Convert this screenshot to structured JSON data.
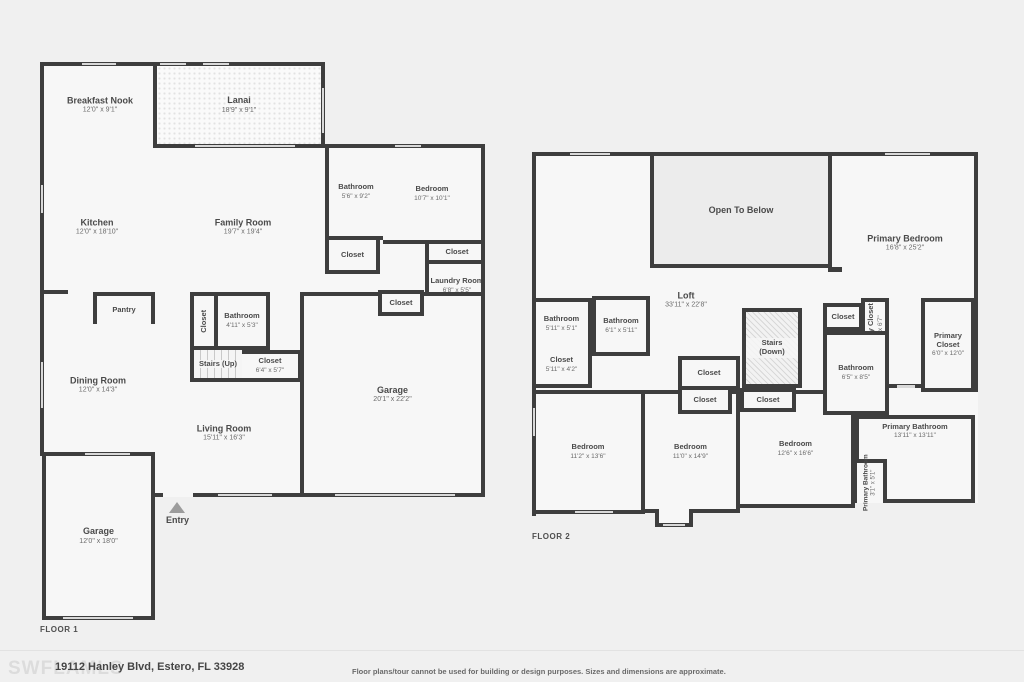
{
  "floor1": {
    "label": "FLOOR 1",
    "rooms": {
      "breakfast_nook": {
        "name": "Breakfast Nook",
        "dims": "12'0\" x 9'1\""
      },
      "lanai": {
        "name": "Lanai",
        "dims": "18'9\" x 9'1\""
      },
      "kitchen": {
        "name": "Kitchen",
        "dims": "12'0\" x 18'10\""
      },
      "family_room": {
        "name": "Family Room",
        "dims": "19'7\" x 19'4\""
      },
      "bathroom1": {
        "name": "Bathroom",
        "dims": "5'6\" x 9'2\""
      },
      "bedroom": {
        "name": "Bedroom",
        "dims": "10'7\" x 10'1\""
      },
      "closet_bath": {
        "name": "Closet"
      },
      "closet_bedroom": {
        "name": "Closet"
      },
      "laundry": {
        "name": "Laundry Room",
        "dims": "6'8\" x 5'5\""
      },
      "closet_garage": {
        "name": "Closet"
      },
      "pantry": {
        "name": "Pantry"
      },
      "closet_stairs": {
        "name": "Closet"
      },
      "bathroom2": {
        "name": "Bathroom",
        "dims": "4'11\" x 5'3\""
      },
      "stairs_up": {
        "name": "Stairs (Up)"
      },
      "closet_hall": {
        "name": "Closet",
        "dims": "6'4\" x 5'7\""
      },
      "dining_room": {
        "name": "Dining Room",
        "dims": "12'0\" x 14'3\""
      },
      "living_room": {
        "name": "Living Room",
        "dims": "15'11\" x 16'3\""
      },
      "garage_main": {
        "name": "Garage",
        "dims": "20'1\" x 22'2\""
      },
      "garage_left": {
        "name": "Garage",
        "dims": "12'0\" x 18'0\""
      },
      "entry": {
        "name": "Entry"
      }
    }
  },
  "floor2": {
    "label": "FLOOR 2",
    "rooms": {
      "open_to_below": {
        "name": "Open To Below"
      },
      "primary_bedroom": {
        "name": "Primary Bedroom",
        "dims": "16'8\" x 25'2\""
      },
      "loft": {
        "name": "Loft",
        "dims": "33'11\" x 22'8\""
      },
      "bathroom_a": {
        "name": "Bathroom",
        "dims": "5'11\" x 5'1\""
      },
      "bathroom_b": {
        "name": "Bathroom",
        "dims": "6'1\" x 5'11\""
      },
      "closet_a": {
        "name": "Closet",
        "dims": "5'11\" x 4'2\""
      },
      "closet_stair": {
        "name": "Closet"
      },
      "closet_bl": {
        "name": "Closet"
      },
      "closet_br": {
        "name": "Closet"
      },
      "stairs_down": {
        "name": "Stairs (Down)"
      },
      "closet_c": {
        "name": "Closet"
      },
      "primary_closet_small": {
        "name": "Primary Closet",
        "dims": "3'1\" x 6'7\""
      },
      "bathroom_c": {
        "name": "Bathroom",
        "dims": "6'5\" x 8'5\""
      },
      "primary_closet": {
        "name": "Primary Closet",
        "dims": "6'0\" x 12'0\""
      },
      "bedroom_l": {
        "name": "Bedroom",
        "dims": "11'2\" x 13'6\""
      },
      "bedroom_m": {
        "name": "Bedroom",
        "dims": "11'0\" x 14'9\""
      },
      "bedroom_r": {
        "name": "Bedroom",
        "dims": "12'6\" x 16'6\""
      },
      "primary_bathroom": {
        "name": "Primary Bathroom",
        "dims": "13'11\" x 13'11\""
      },
      "primary_bathroom_small": {
        "name": "Primary Bathroom",
        "dims": "3'1\" x 5'1\""
      }
    }
  },
  "footer": {
    "watermark": "SWFLAMLS",
    "address": "19112 Hanley Blvd, Estero, FL 33928",
    "disclaimer": "Floor plans/tour cannot be used for building or design purposes. Sizes and dimensions are approximate."
  },
  "colors": {
    "wall": "#3e3e3e",
    "room_fill": "#f7f7f7",
    "open_to_below_fill": "#ececec",
    "background": "#f0f0f0"
  }
}
